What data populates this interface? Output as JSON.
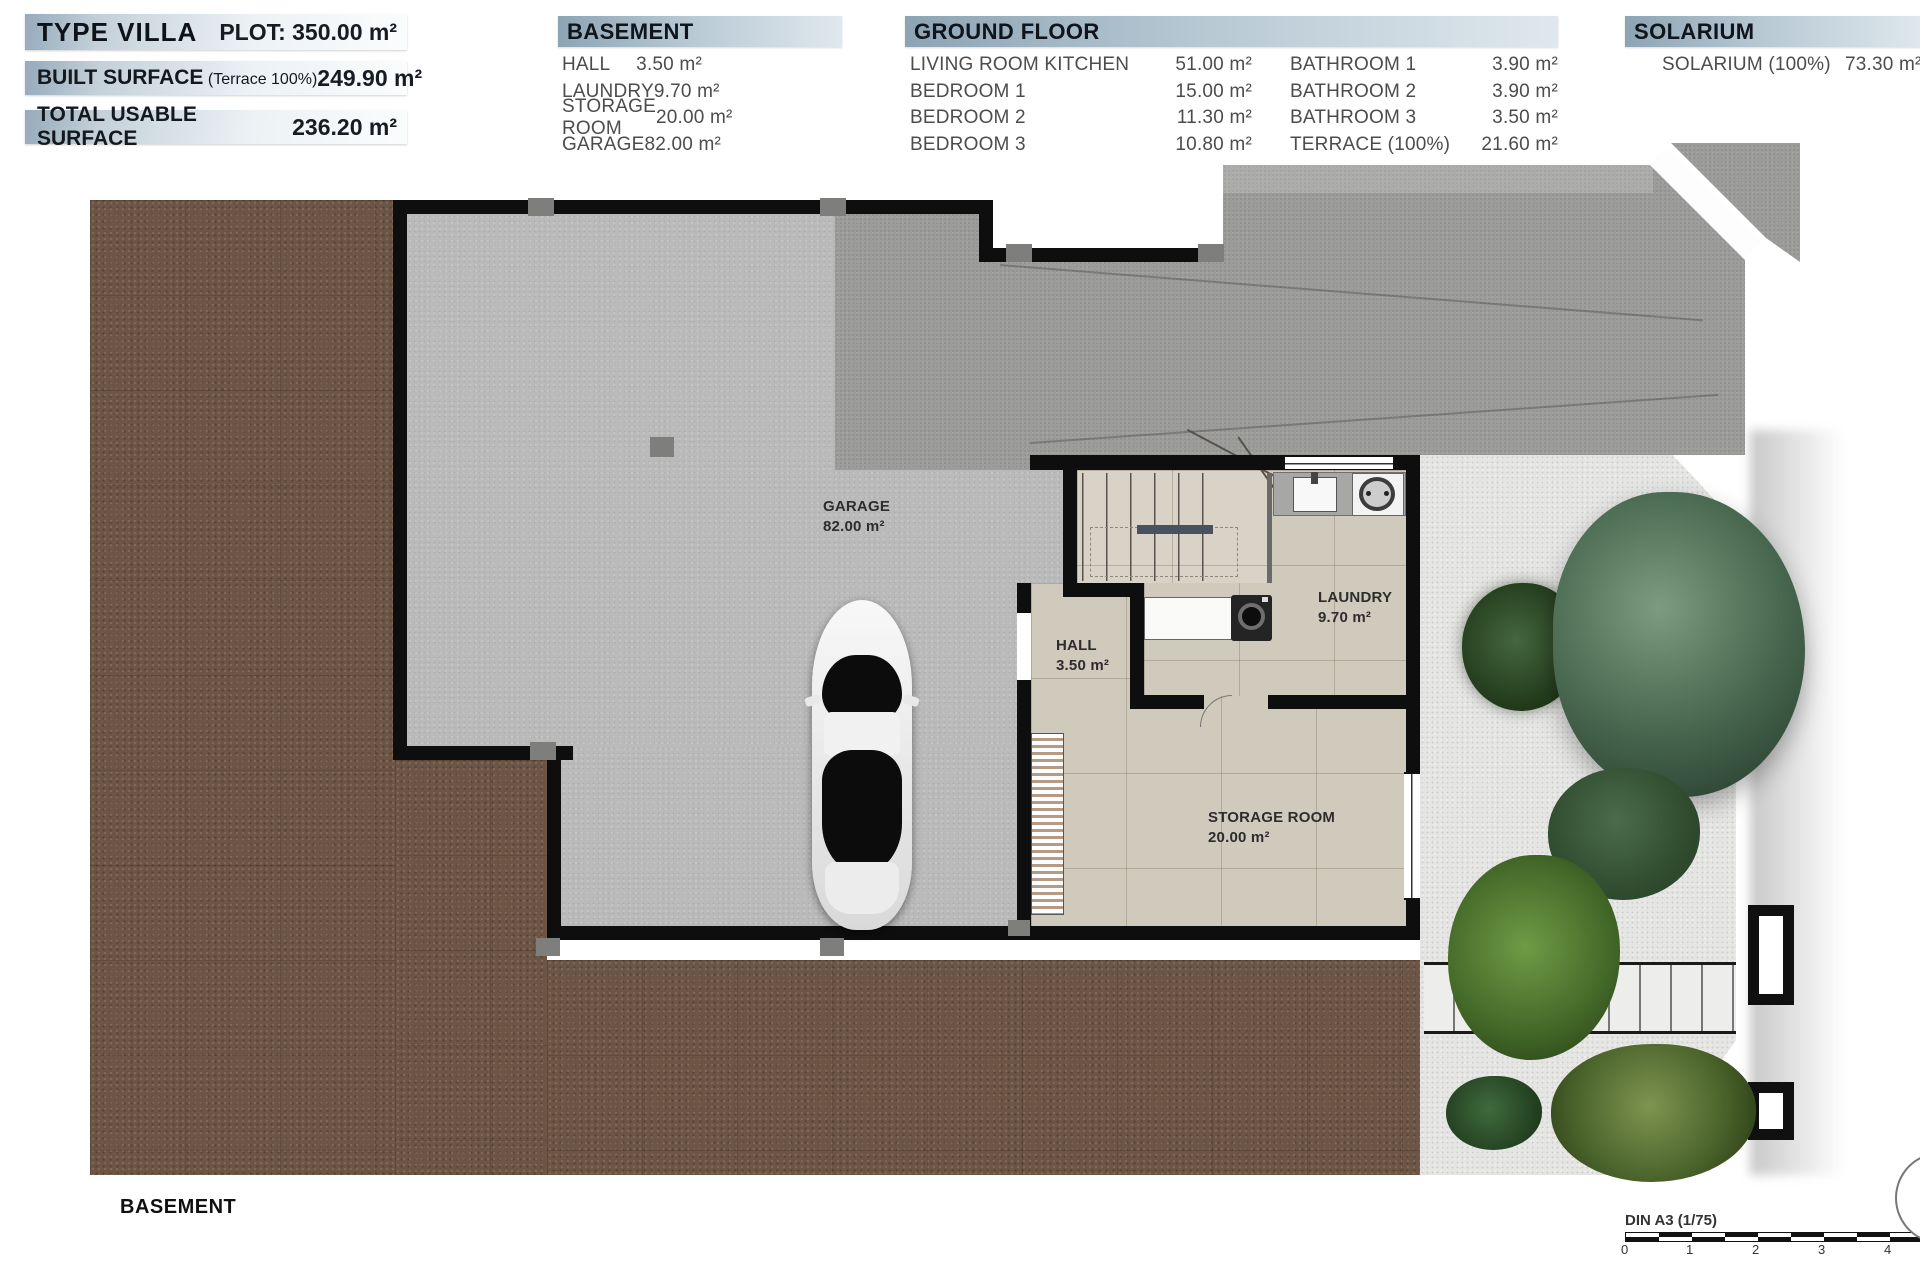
{
  "tables": {
    "summary": [
      {
        "label": "TYPE VILLA",
        "value": "PLOT: 350.00 m²"
      },
      {
        "label": "BUILT SURFACE",
        "note": "(Terrace 100%)",
        "value": "249.90 m²"
      },
      {
        "label": "TOTAL USABLE SURFACE",
        "note": "",
        "value": "236.20 m²"
      }
    ],
    "basement": {
      "title": "BASEMENT",
      "rows": [
        {
          "label": "HALL",
          "value": "3.50 m²"
        },
        {
          "label": "LAUNDRY",
          "value": "9.70 m²"
        },
        {
          "label": "STORAGE ROOM",
          "value": "20.00 m²"
        },
        {
          "label": "GARAGE",
          "value": "82.00 m²"
        }
      ]
    },
    "ground": {
      "title": "GROUND FLOOR",
      "left": [
        {
          "label": "LIVING ROOM KITCHEN",
          "value": "51.00 m²"
        },
        {
          "label": "BEDROOM 1",
          "value": "15.00 m²"
        },
        {
          "label": "BEDROOM 2",
          "value": "11.30 m²"
        },
        {
          "label": "BEDROOM 3",
          "value": "10.80 m²"
        }
      ],
      "right": [
        {
          "label": "BATHROOM 1",
          "value": "3.90 m²"
        },
        {
          "label": "BATHROOM 2",
          "value": "3.90 m²"
        },
        {
          "label": "BATHROOM 3",
          "value": "3.50 m²"
        },
        {
          "label": "TERRACE (100%)",
          "value": "21.60 m²"
        }
      ]
    },
    "solarium": {
      "title": "SOLARIUM",
      "row": {
        "label": "SOLARIUM (100%)",
        "value": "73.30 m²"
      }
    }
  },
  "plan": {
    "rooms": {
      "garage": {
        "name": "GARAGE",
        "area": "82.00 m²"
      },
      "hall": {
        "name": "HALL",
        "area": "3.50 m²"
      },
      "laundry": {
        "name": "LAUNDRY",
        "area": "9.70 m²"
      },
      "storage": {
        "name": "STORAGE ROOM",
        "area": "20.00 m²"
      }
    },
    "floor_label": "BASEMENT"
  },
  "scale": {
    "label": "DIN A3 (1/75)",
    "ticks": [
      "0",
      "1",
      "2",
      "3",
      "4"
    ]
  },
  "colors": {
    "wall": "#0e0e0e",
    "brown": "#6d5546",
    "concrete": "#bababa",
    "asphalt": "#9c9c9a",
    "tile": "#d0cabc",
    "wgravel": "#e5e5e3",
    "header-dark": "#8da4b5",
    "header-light": "#dfe8ee",
    "tree-green": "#3f5c3f"
  }
}
